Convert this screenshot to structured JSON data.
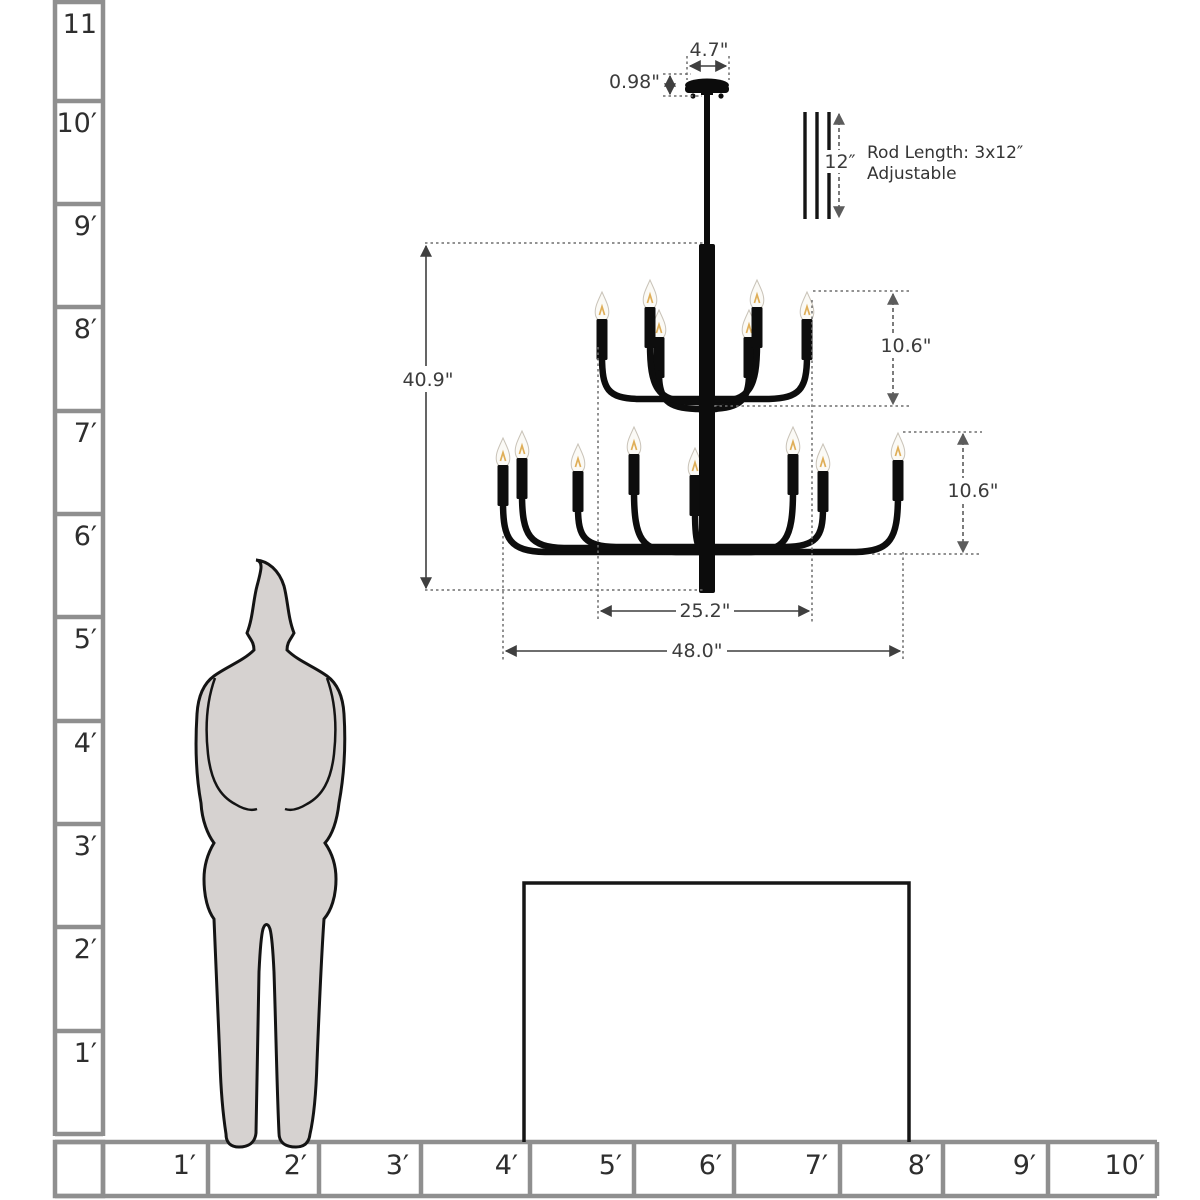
{
  "ruler": {
    "vertical_labels": [
      "11",
      "10′",
      "9′",
      "8′",
      "7′",
      "6′",
      "5′",
      "4′",
      "3′",
      "2′",
      "1′"
    ],
    "horizontal_labels": [
      "1′",
      "2′",
      "3′",
      "4′",
      "5′",
      "6′",
      "7′",
      "8′",
      "9′",
      "10′"
    ]
  },
  "dims": {
    "canopy_width": "4.7\"",
    "canopy_height": "0.98\"",
    "rod_segment": "12″",
    "rod_note_line1": "Rod Length: 3x12″",
    "rod_note_line2": "Adjustable",
    "overall_height": "40.9\"",
    "top_tier_height": "10.6\"",
    "bottom_tier_height": "10.6\"",
    "top_tier_width": "25.2\"",
    "overall_width": "48.0\""
  },
  "colors": {
    "chandelier": "#0d0d0d",
    "silhouette_fill": "#d6d2d0",
    "ruler_grid": "#8f8f8f",
    "dimension_line": "#3f3f3f",
    "bulb": "#fbfaf6",
    "filament": "#dfae58"
  }
}
